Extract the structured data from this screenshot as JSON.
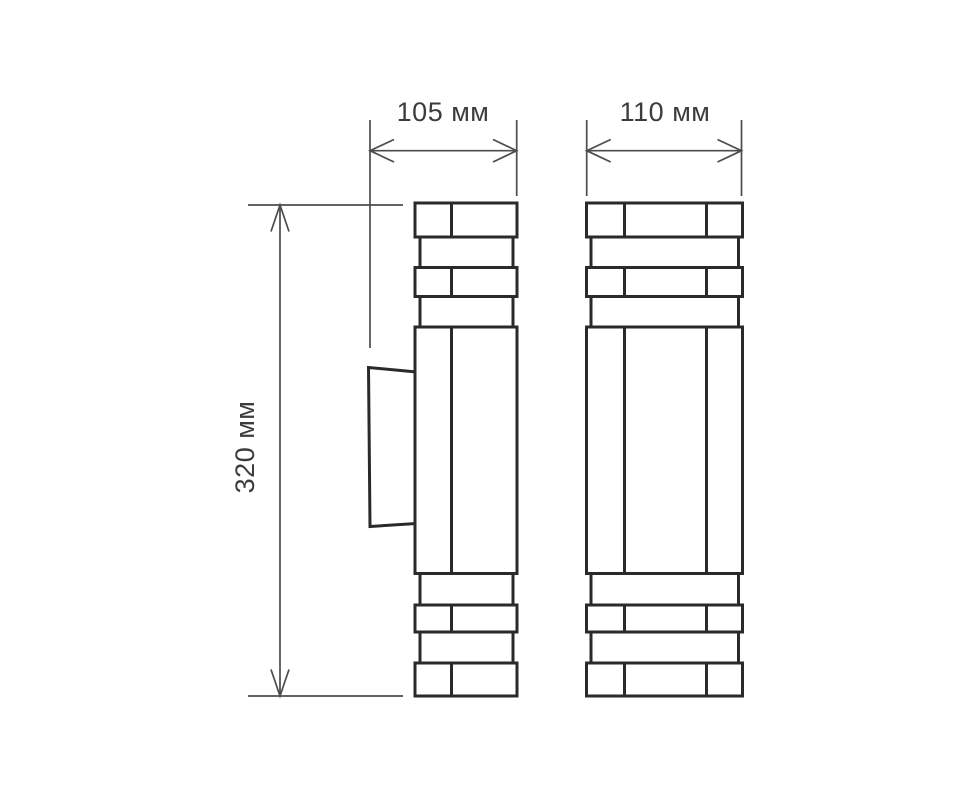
{
  "drawing": {
    "dimensions": {
      "side_width": "105 мм",
      "front_width": "110 мм",
      "height": "320 мм"
    },
    "colors": {
      "background": "#ffffff",
      "outline": "#2a2a2a",
      "dimension_line": "#4c4c4c",
      "label_text": "#3c3c3c"
    }
  }
}
